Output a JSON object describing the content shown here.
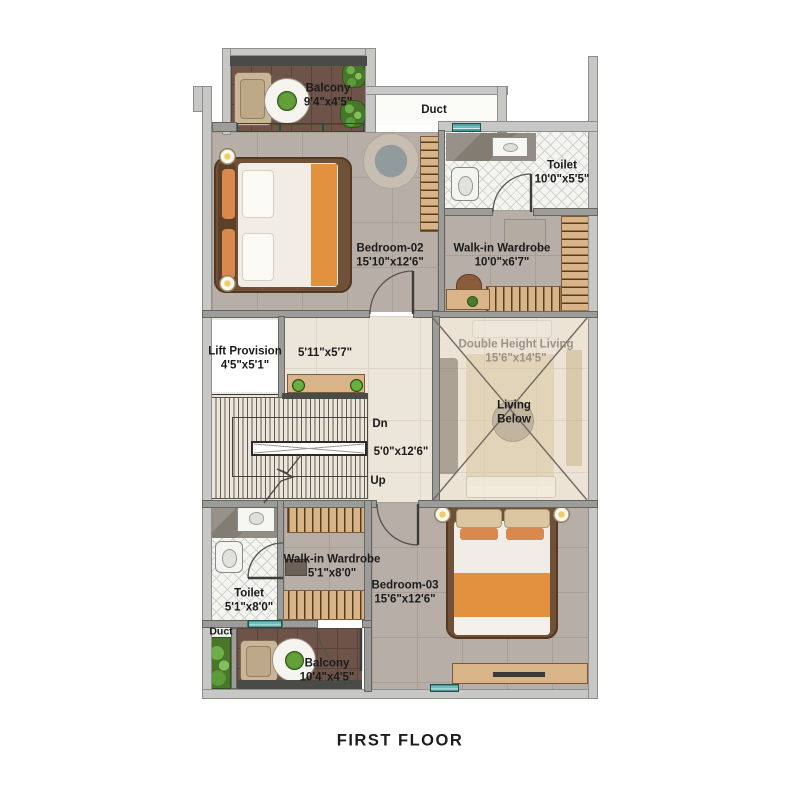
{
  "title": "FIRST FLOOR",
  "rooms": {
    "balcony_top": {
      "name": "Balcony",
      "dims": "9'4\"x4'5\""
    },
    "duct_top": {
      "name": "Duct"
    },
    "toilet_top": {
      "name": "Toilet",
      "dims": "10'0\"x5'5\""
    },
    "bedroom_02": {
      "name": "Bedroom-02",
      "dims": "15'10\"x12'6\""
    },
    "wardrobe_top": {
      "name": "Walk-in Wardrobe",
      "dims": "10'0\"x6'7\""
    },
    "lift": {
      "name": "Lift Provision",
      "dims": "4'5\"x5'1\""
    },
    "foyer": {
      "dims": "5'11\"x5'7\""
    },
    "double_height_living": {
      "name": "Double Height Living",
      "dims": "15'6\"x14'5\"",
      "note_line1": "Living",
      "note_line2": "Below"
    },
    "stairs": {
      "down_label": "Dn",
      "dims": "5'0\"x12'6\"",
      "up_label": "Up"
    },
    "wardrobe_bottom": {
      "name": "Walk-in Wardrobe",
      "dims": "5'1\"x8'0\""
    },
    "toilet_bottom": {
      "name": "Toilet",
      "dims": "5'1\"x8'0\""
    },
    "duct_bottom": {
      "name": "Duct"
    },
    "balcony_bottom": {
      "name": "Balcony",
      "dims": "10'4\"x4'5\""
    },
    "bedroom_03": {
      "name": "Bedroom-03",
      "dims": "15'6\"x12'6\""
    }
  },
  "colors": {
    "wall_gray": "#c7c7c5",
    "partition_gray": "#9c9c9a",
    "window_teal": "#6fbcb8",
    "floor_taupe": "#b7afa7",
    "floor_cream": "#ece5da",
    "balcony_brown": "#6d5348",
    "wood": "#d8b488",
    "accent_orange": "#e2913f",
    "plant_green": "#4e8a34"
  }
}
